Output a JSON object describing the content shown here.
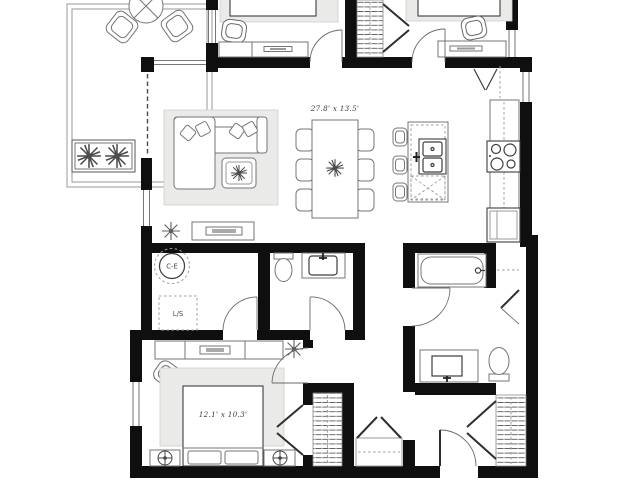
{
  "canvas": {
    "width": 640,
    "height": 480,
    "background": "#ffffff"
  },
  "colors": {
    "wall": "#0f0f0f",
    "stroke_dark": "#3d3d3d",
    "stroke_mid": "#767676",
    "stroke_light": "#a0a0a0",
    "fill_soft": "#eaeae8",
    "label_text": "#3a3a3a"
  },
  "labels": {
    "living_dining_dim": "27.8' x 13.5'",
    "master_bedroom_dim": "12.1' x 10.3'",
    "water_heater": "C-E",
    "washer_dryer": "L/S"
  },
  "legend": {
    "fixtures": [
      "balcony-bistro-table",
      "balcony-chair",
      "planter-box",
      "sectional-sofa",
      "coffee-table",
      "tv-console",
      "ceiling-fan",
      "dining-table",
      "dining-chair",
      "kitchen-island",
      "double-sink",
      "dishwasher",
      "bar-stool",
      "cooktop",
      "refrigerator",
      "pantry-bifold-door",
      "bathtub",
      "vanity-sink",
      "toilet",
      "water-heater",
      "washer-dryer",
      "bed",
      "nightstand",
      "table-lamp",
      "dresser",
      "desk",
      "closet-hanging-rod",
      "entry-door"
    ]
  }
}
